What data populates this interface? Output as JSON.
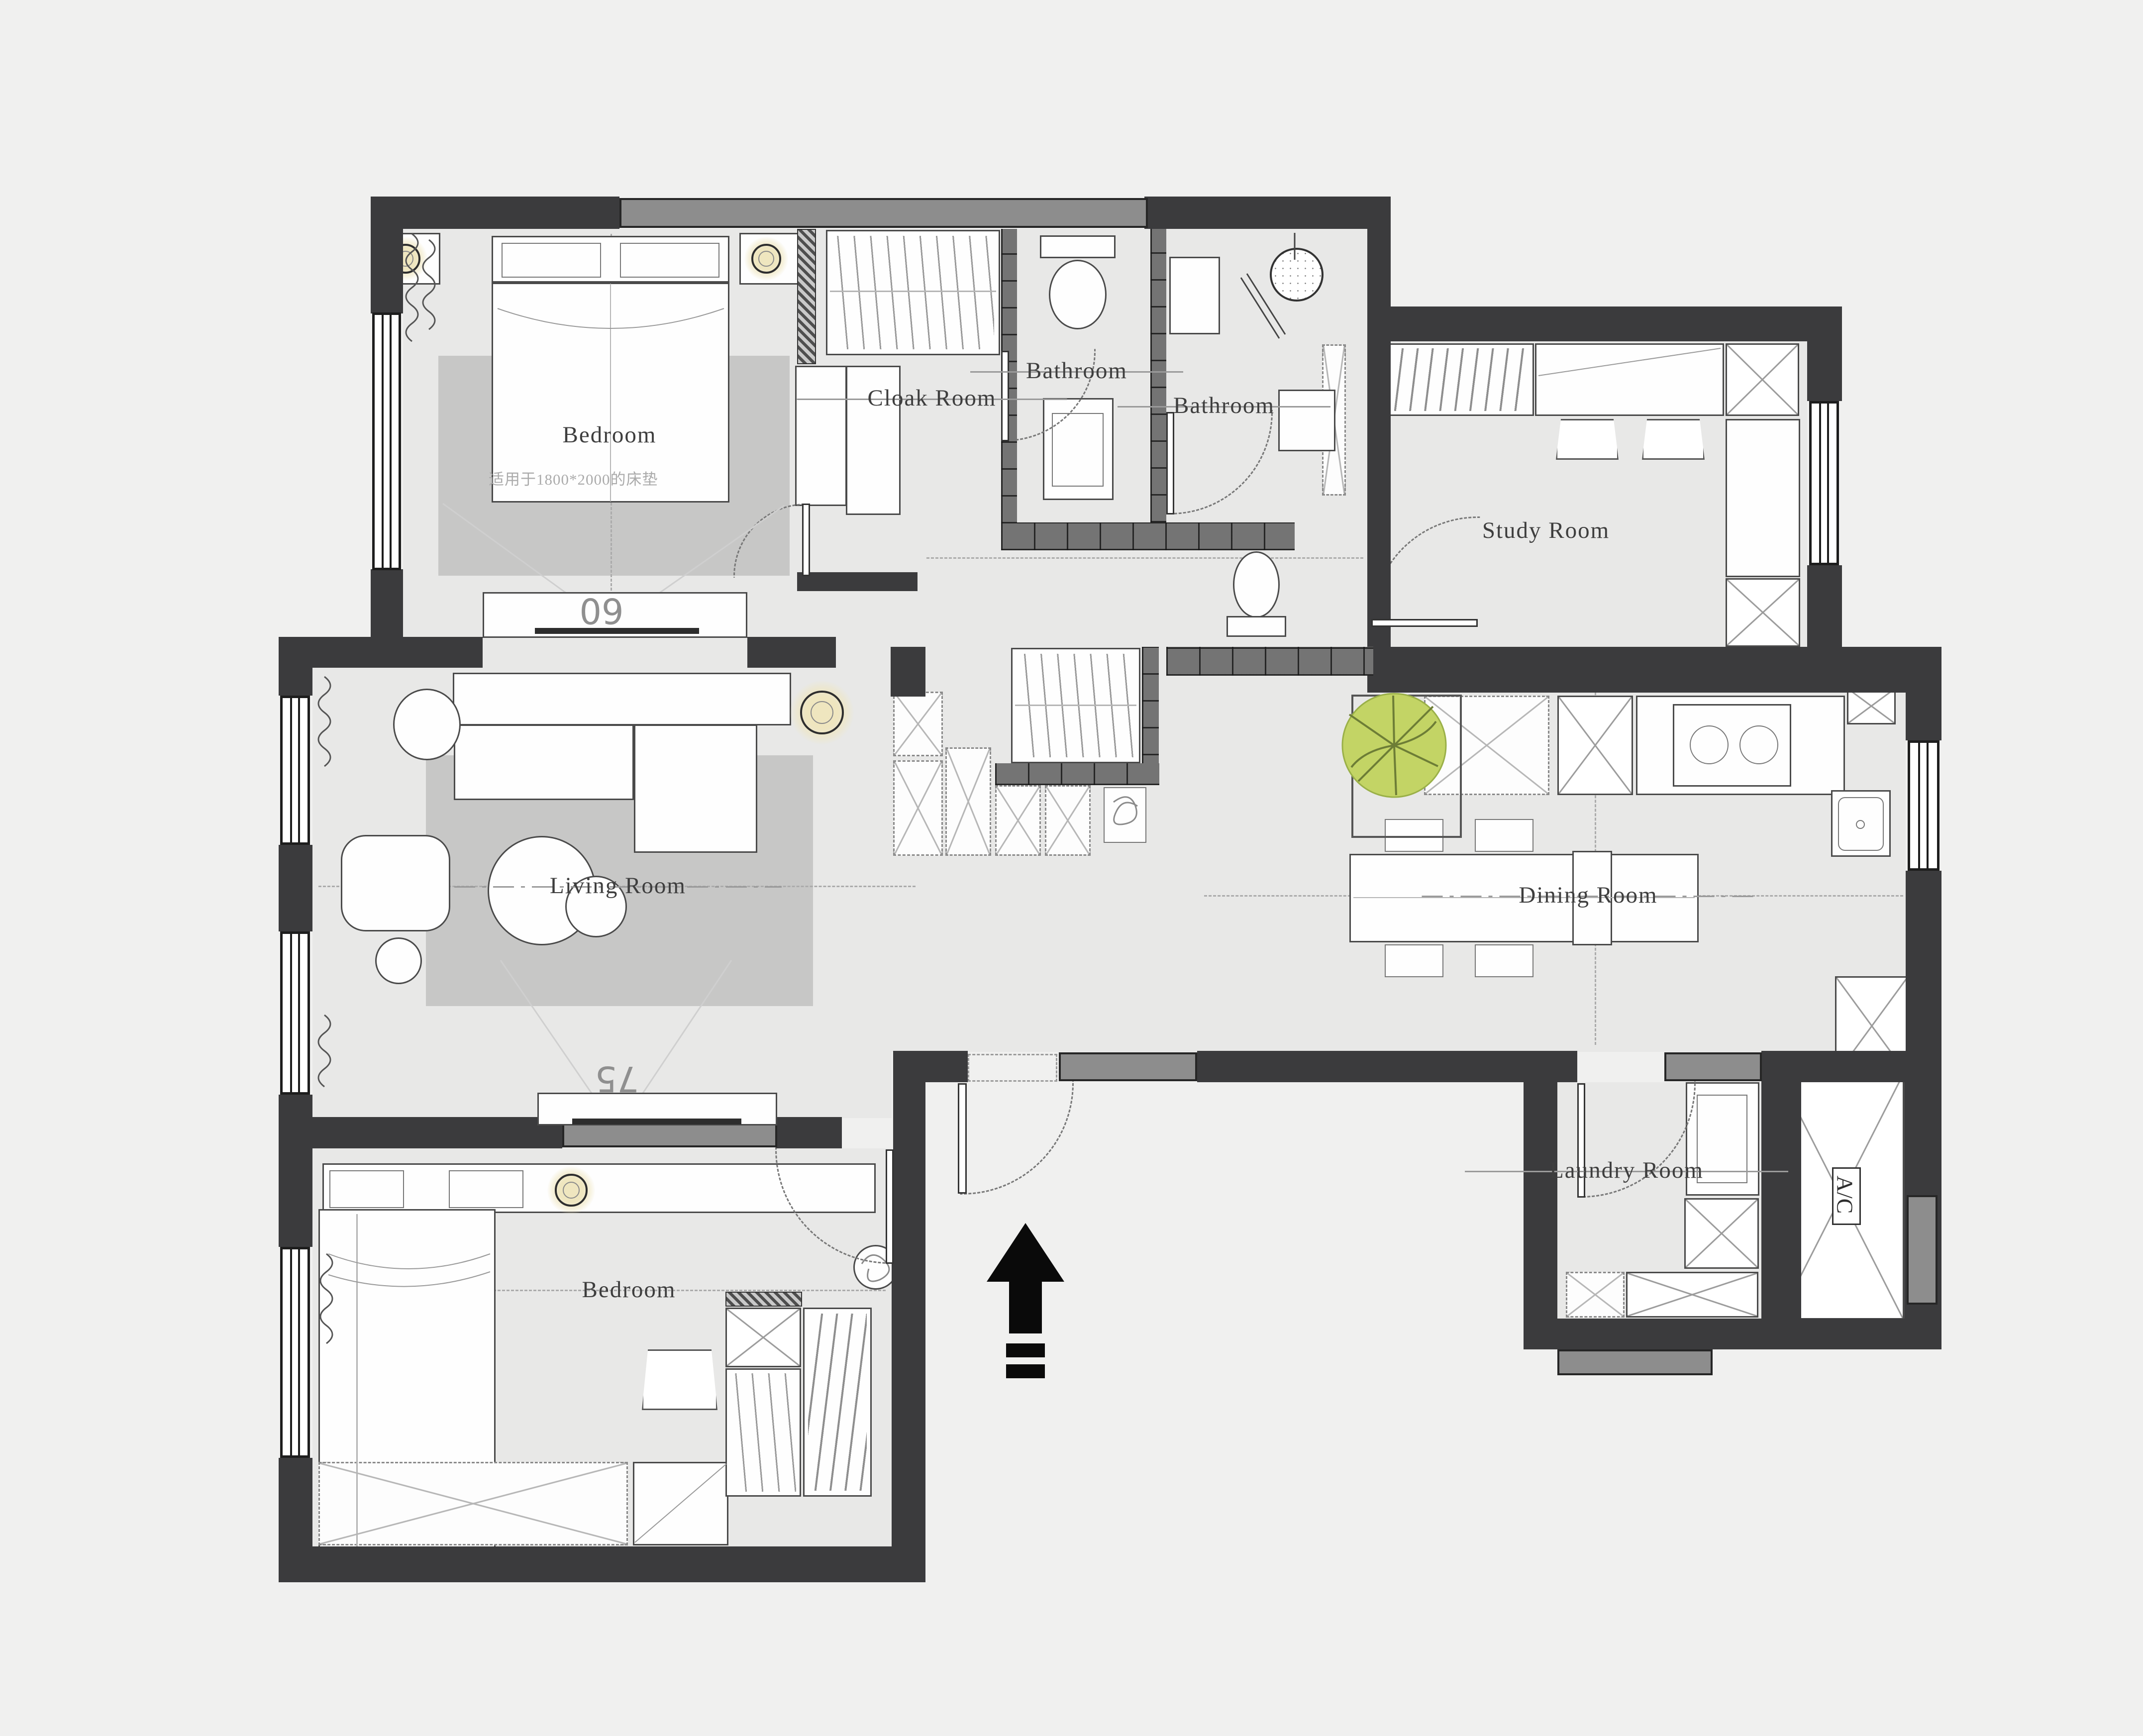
{
  "drawing": {
    "type": "apartment-floor-plan",
    "style": "CAD top-view interior layout"
  },
  "labels": {
    "bedroom_master": "Bedroom",
    "bedroom_master_note": "适用于1800*2000的床垫",
    "cloak_room": "Cloak Room",
    "bathroom_1": "Bathroom",
    "bathroom_2": "Bathroom",
    "study_room": "Study Room",
    "living_room": "Living Room",
    "dining_room": "Dining Room",
    "laundry_room": "Laundry Room",
    "bedroom_second": "Bedroom",
    "tv_size_master": "60",
    "tv_size_living": "75",
    "ac_unit": "A/C"
  },
  "colors": {
    "wall": "#3b3b3d",
    "window_sill": "#8d8d8d",
    "tile_wall": "#747474",
    "floor": "#e8e8e7",
    "rug": "#c7c7c6",
    "background": "#f0f0ef",
    "plant_green": "#c3d465",
    "lamp_glow": "#efe6bf",
    "entrance_arrow": "#0a0a0a"
  }
}
